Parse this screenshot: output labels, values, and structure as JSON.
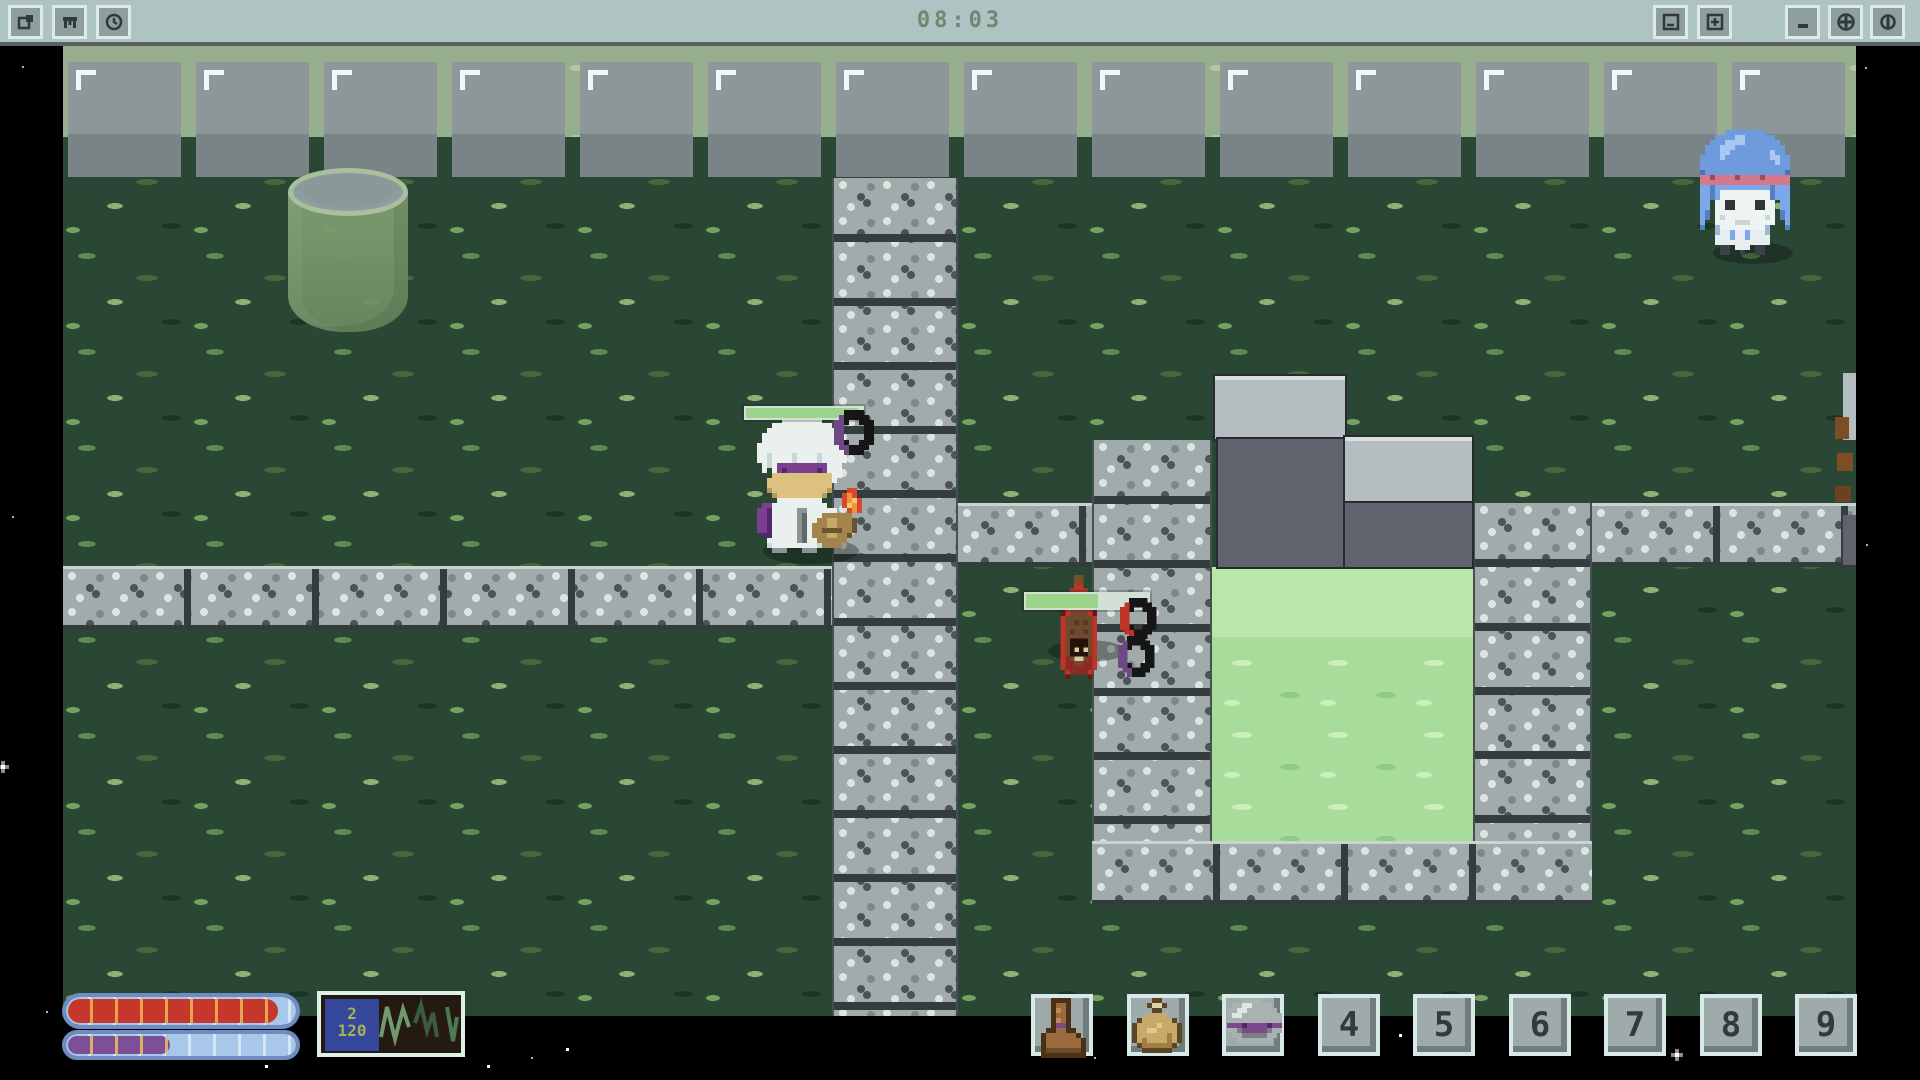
{
  "window": {
    "clock": "08:03",
    "titlebar_left_buttons": [
      {
        "icon": "map-icon"
      },
      {
        "icon": "inventory-icon"
      },
      {
        "icon": "clock-icon"
      }
    ],
    "titlebar_right_buttons": [
      {
        "icon": "zoom-out-icon"
      },
      {
        "icon": "zoom-in-icon"
      },
      {
        "icon": "minimize-icon"
      },
      {
        "icon": "maximize-icon"
      },
      {
        "icon": "close-icon"
      }
    ]
  },
  "hud": {
    "health_bar": {
      "fill_pct": 93,
      "fill_color": "#c5372b",
      "tick_color": "#e9a34f",
      "track_color": "#a9c7e8"
    },
    "mana_bar": {
      "fill_pct": 46,
      "fill_color": "#7d4f97",
      "tick_color": "#d8b06a",
      "track_color": "#a9c7e8"
    },
    "stats_panel": {
      "line1": "2",
      "line2": "120"
    },
    "hotbar_slots": [
      {
        "item": "boot"
      },
      {
        "item": "pouch"
      },
      {
        "item": "helmet"
      },
      {
        "label": "4"
      },
      {
        "label": "5"
      },
      {
        "label": "6"
      },
      {
        "label": "7"
      },
      {
        "label": "8"
      },
      {
        "label": "9"
      }
    ]
  },
  "entities": {
    "player": {
      "hp_pct": 97
    },
    "enemy": {
      "hp_pct": 60
    },
    "npc": {
      "description": "blue-haired npc"
    }
  },
  "colors": {
    "titlebar": "#adc4c2",
    "grass": "#2a4634",
    "ledge": "#97ae8e",
    "stone": "#a2abab",
    "water": "#a8dc9b",
    "space": "#000000"
  }
}
